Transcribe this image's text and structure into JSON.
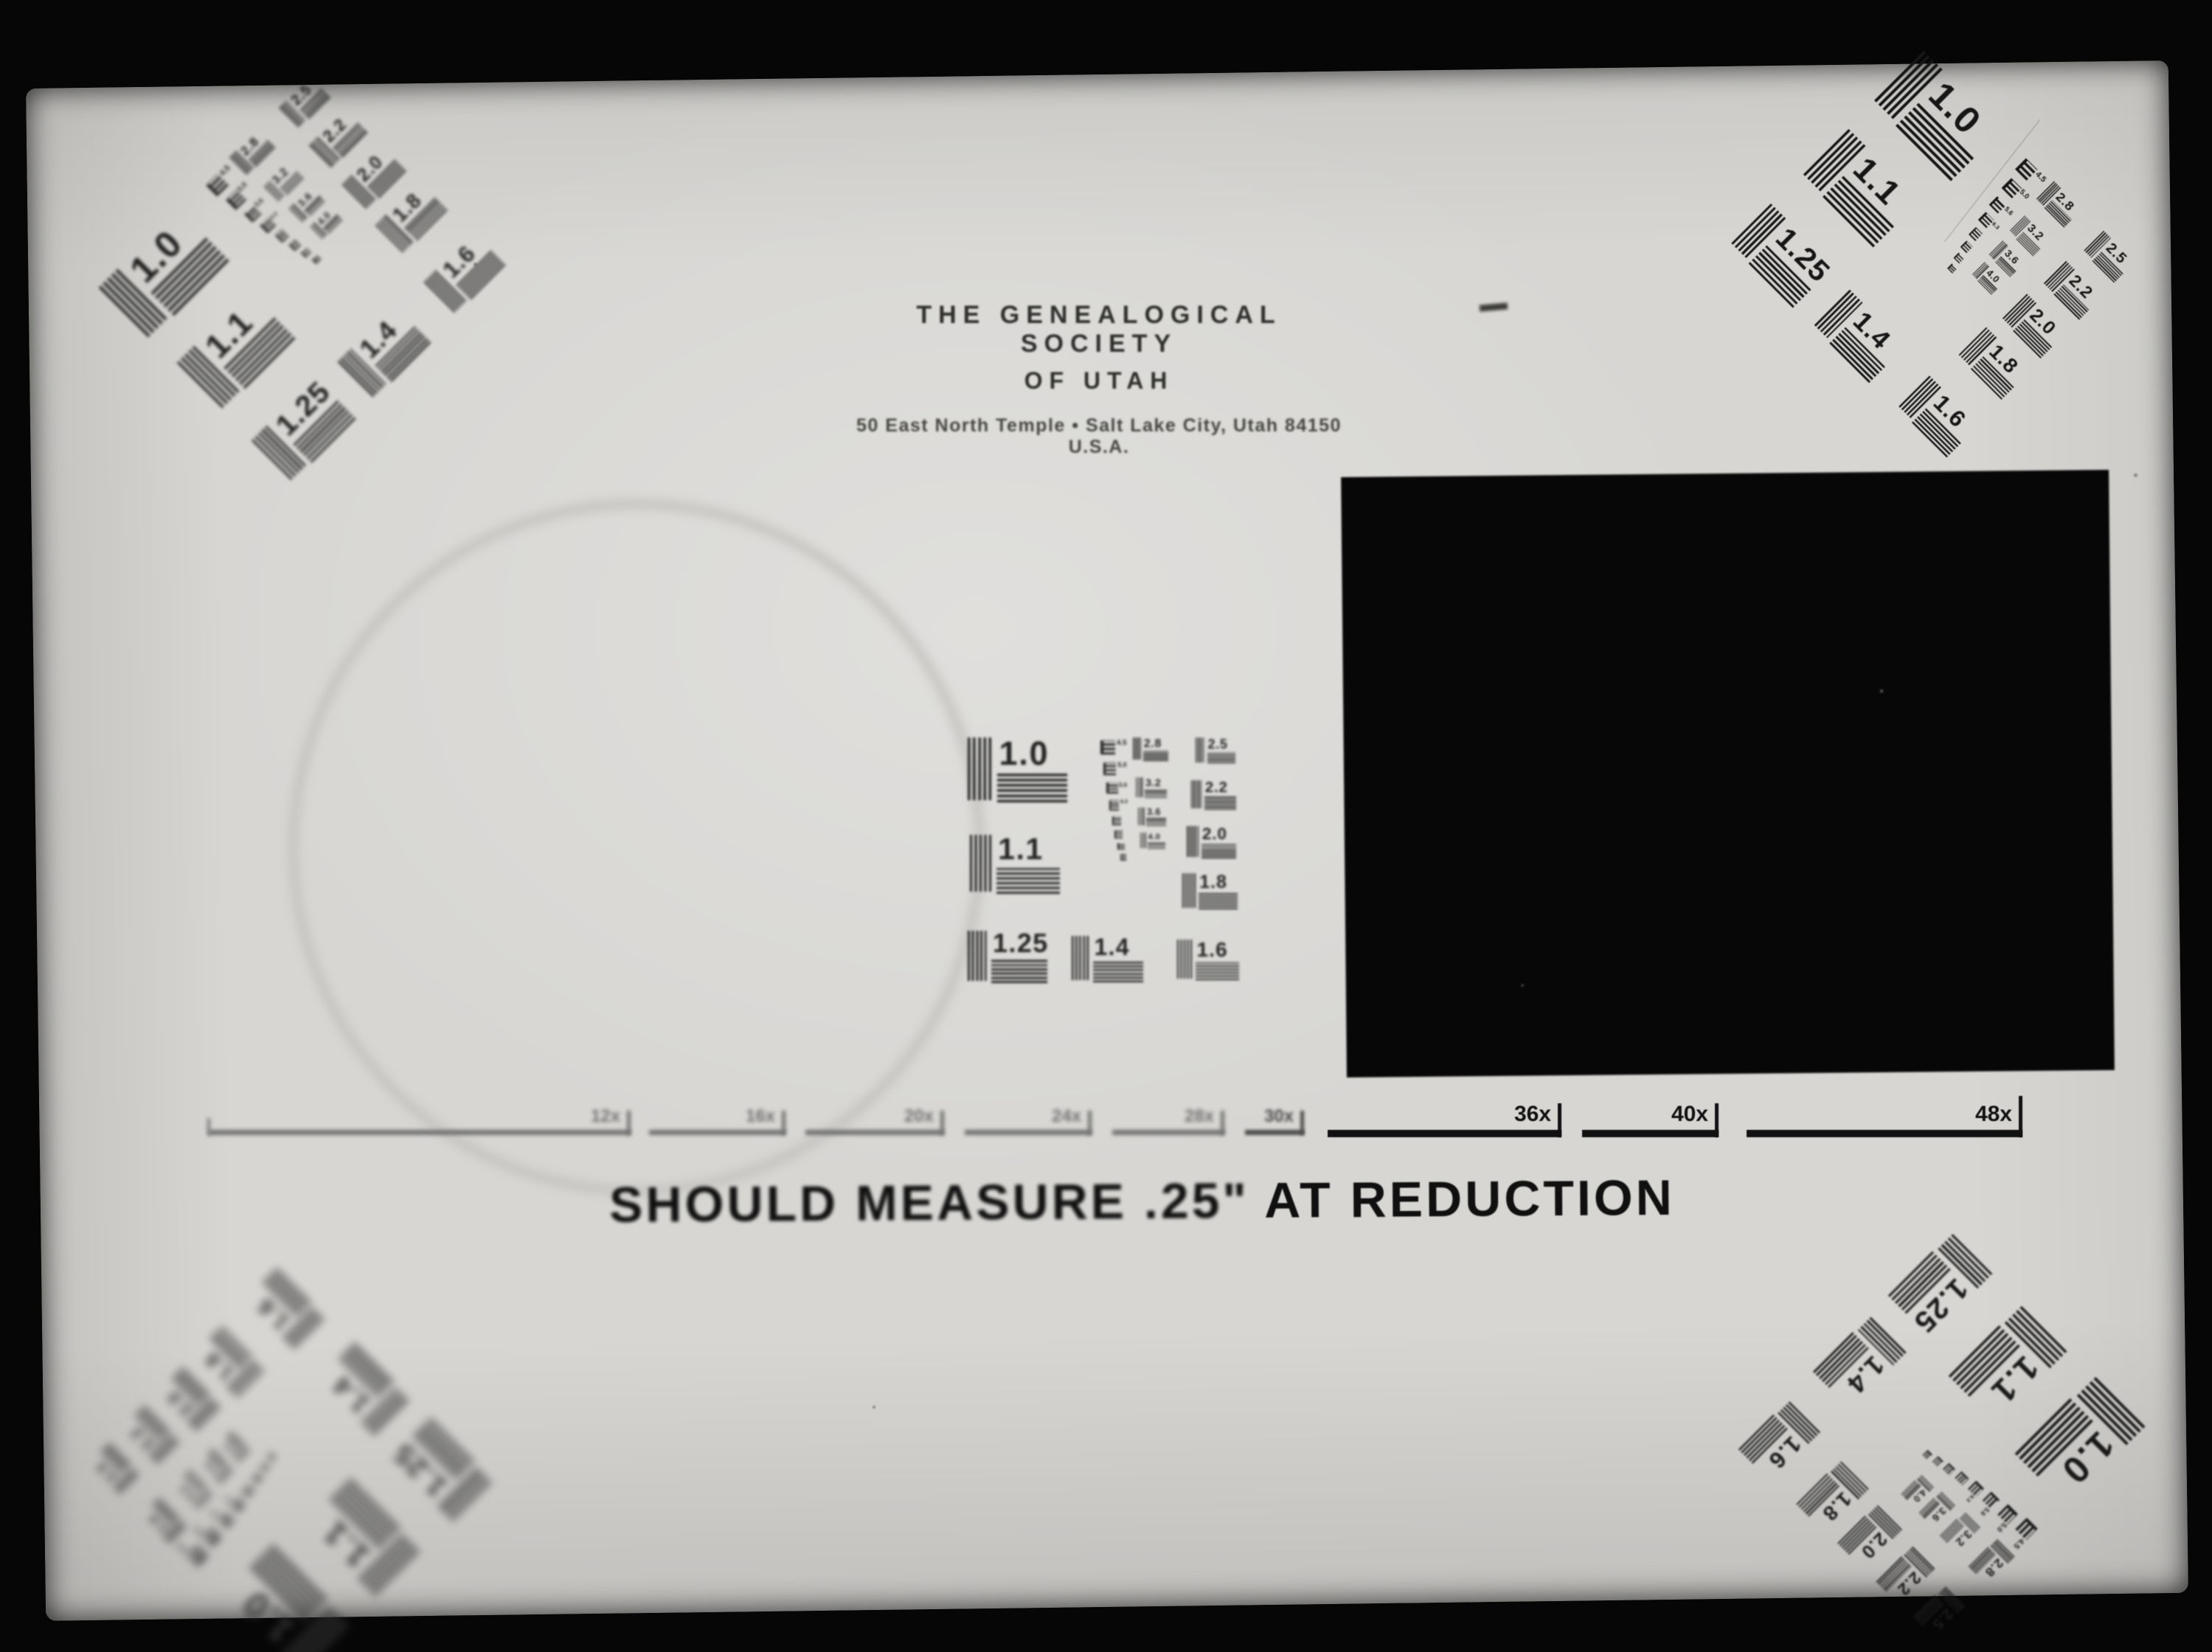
{
  "document_type": "microfilm resolution test target",
  "header": {
    "org_line1": "THE GENEALOGICAL SOCIETY",
    "org_line2": "OF UTAH",
    "address": "50 East North Temple • Salt Lake City, Utah 84150 U.S.A."
  },
  "caption": {
    "parts": [
      "SHOULD MEASURE .25\"",
      " AT REDUCTION"
    ]
  },
  "ruler": {
    "labels": [
      "12x",
      "16x",
      "20x",
      "24x",
      "28x",
      "30x",
      "36x",
      "40x",
      "48x"
    ]
  },
  "resolution_chart": {
    "element_labels": [
      "1.0",
      "1.1",
      "1.25",
      "1.4",
      "1.6",
      "1.8",
      "2.0",
      "2.2",
      "2.5",
      "2.8",
      "3.2",
      "3.6",
      "4.0"
    ],
    "micro_labels": [
      "4.5",
      "5.0",
      "5.6",
      "6.3",
      "7.1",
      "8.0",
      "9.0",
      "10"
    ],
    "groups": [
      {
        "name": "center-target"
      },
      {
        "name": "top-left-target"
      },
      {
        "name": "top-right-target"
      },
      {
        "name": "bottom-left-target"
      },
      {
        "name": "bottom-right-target"
      }
    ]
  },
  "colors": {
    "film_background": "#060606",
    "page": "#d7d6d3",
    "ink": "#1b1b1b",
    "density_patch": "#070707"
  }
}
